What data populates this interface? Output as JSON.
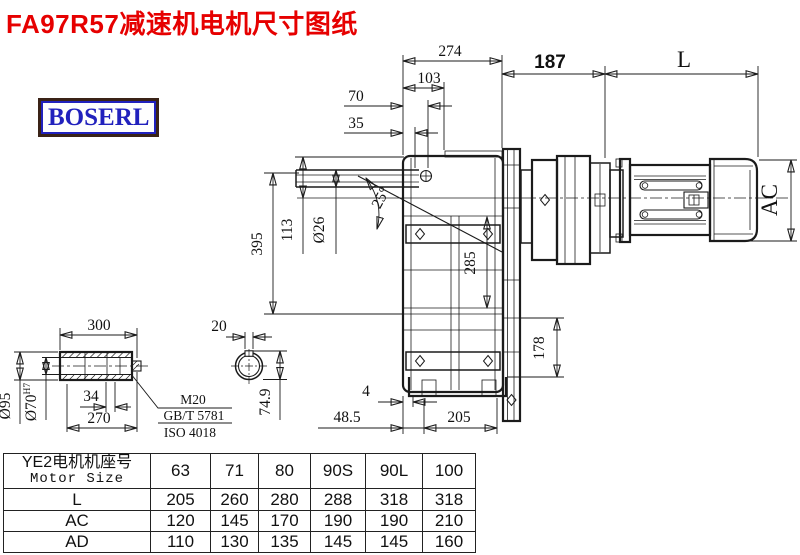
{
  "title": "FA97R57减速机电机尺寸图纸",
  "brand": "BOSERL",
  "colors": {
    "title_red": "#e60000",
    "brand_blue": "#2121bd",
    "brand_border_brown": "#3a2317",
    "line": "#1b1b1b"
  },
  "dims": {
    "w274": "274",
    "w103": "103",
    "w70": "70",
    "w35": "35",
    "w187": "187",
    "motor_len": "L",
    "angle": "25°",
    "bore_small": "Ø26",
    "h113": "113",
    "h395": "395",
    "h285": "285",
    "h178": "178",
    "motor_dia": "AC",
    "gap4": "4",
    "w48_5": "48.5",
    "w205": "205",
    "shaft_len": "300",
    "key_w": "20",
    "shaft_od": "Ø95",
    "bore": "Ø70",
    "bore_tol": "H7",
    "w34": "34",
    "w270": "270",
    "key_h": "74.9"
  },
  "notes": {
    "bolt": "M20",
    "std1": "GB/T 5781",
    "std2": "ISO 4018"
  },
  "table": {
    "header_cn": "YE2电机机座号",
    "header_en": "Motor Size",
    "sizes": [
      "63",
      "71",
      "80",
      "90S",
      "90L",
      "100"
    ],
    "rows": [
      {
        "label": "L",
        "values": [
          "205",
          "260",
          "280",
          "288",
          "318",
          "318"
        ]
      },
      {
        "label": "AC",
        "values": [
          "120",
          "145",
          "170",
          "190",
          "190",
          "210"
        ]
      },
      {
        "label": "AD",
        "values": [
          "110",
          "130",
          "135",
          "145",
          "145",
          "160"
        ]
      }
    ]
  }
}
